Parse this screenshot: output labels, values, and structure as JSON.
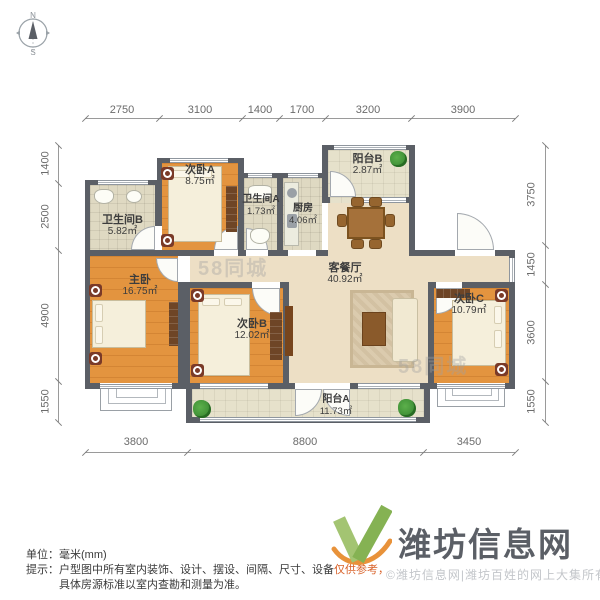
{
  "compass": {
    "north": "N",
    "south": "S"
  },
  "dims": {
    "top": [
      "2750",
      "3100",
      "1400",
      "1700",
      "3200",
      "3900"
    ],
    "bottom": [
      "3800",
      "8800",
      "3450"
    ],
    "left": [
      "1400",
      "2500",
      "4900",
      "1550"
    ],
    "right": [
      "3750",
      "1450",
      "3600",
      "1550"
    ]
  },
  "rooms": {
    "bathB": {
      "name": "卫生间B",
      "area": "5.82㎡"
    },
    "bedA": {
      "name": "次卧A",
      "area": "8.75㎡"
    },
    "bathA": {
      "name": "卫生间A",
      "area": "1.73㎡"
    },
    "kitchen": {
      "name": "厨房",
      "area": "4.06㎡"
    },
    "balconyB": {
      "name": "阳台B",
      "area": "2.87㎡"
    },
    "living": {
      "name": "客餐厅",
      "area": "40.92㎡"
    },
    "master": {
      "name": "主卧",
      "area": "16.75㎡"
    },
    "bedB": {
      "name": "次卧B",
      "area": "12.02㎡"
    },
    "bedC": {
      "name": "次卧C",
      "area": "10.79㎡"
    },
    "balconyA": {
      "name": "阳台A",
      "area": "11.73㎡"
    }
  },
  "watermark": {
    "text": "58同城"
  },
  "footer": {
    "unit": "单位：毫米(mm)",
    "tip_prefix": "提示：",
    "tip_main": "户型图中所有室内装饰、设计、摆设、间隔、尺寸、设备",
    "tip_highlight": "仅供参考，",
    "tip_line2": "具体房源标准以室内查勘和测量为准。",
    "logo_text": "潍坊信息网",
    "copyright": "©潍坊信息网|潍坊百姓的网上大集所有"
  },
  "colors": {
    "wall": "#5b5f66",
    "wood_floor": "#e3943f",
    "living_floor": "#eddfc5",
    "logo_green": "#85b253",
    "logo_orange": "#e8923a"
  }
}
